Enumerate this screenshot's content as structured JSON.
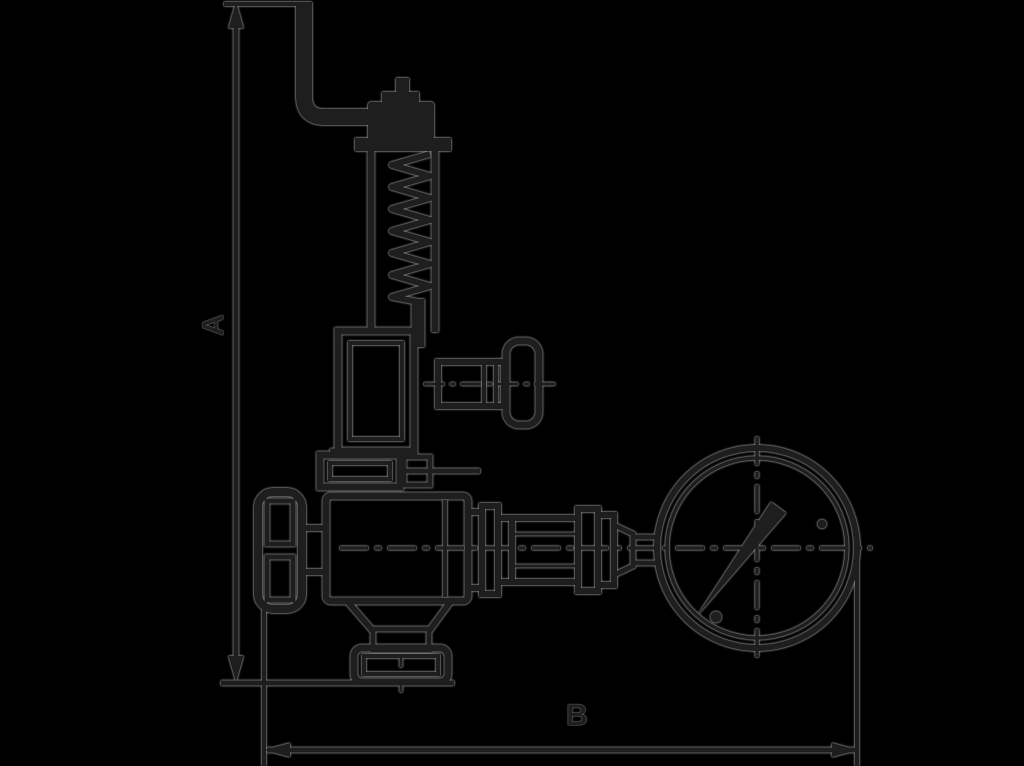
{
  "figure": {
    "kind": "technical line drawing",
    "subject": "safety relief valve with lift lever, spring bonnet, side test connection, shut-off handwheel and pressure gauge",
    "background_color": "#000000",
    "ink_color": "#1e1e1e",
    "halo_color": "#969696"
  },
  "dimensions": {
    "a": {
      "label": "A",
      "orientation": "vertical"
    },
    "b": {
      "label": "B",
      "orientation": "horizontal"
    }
  }
}
